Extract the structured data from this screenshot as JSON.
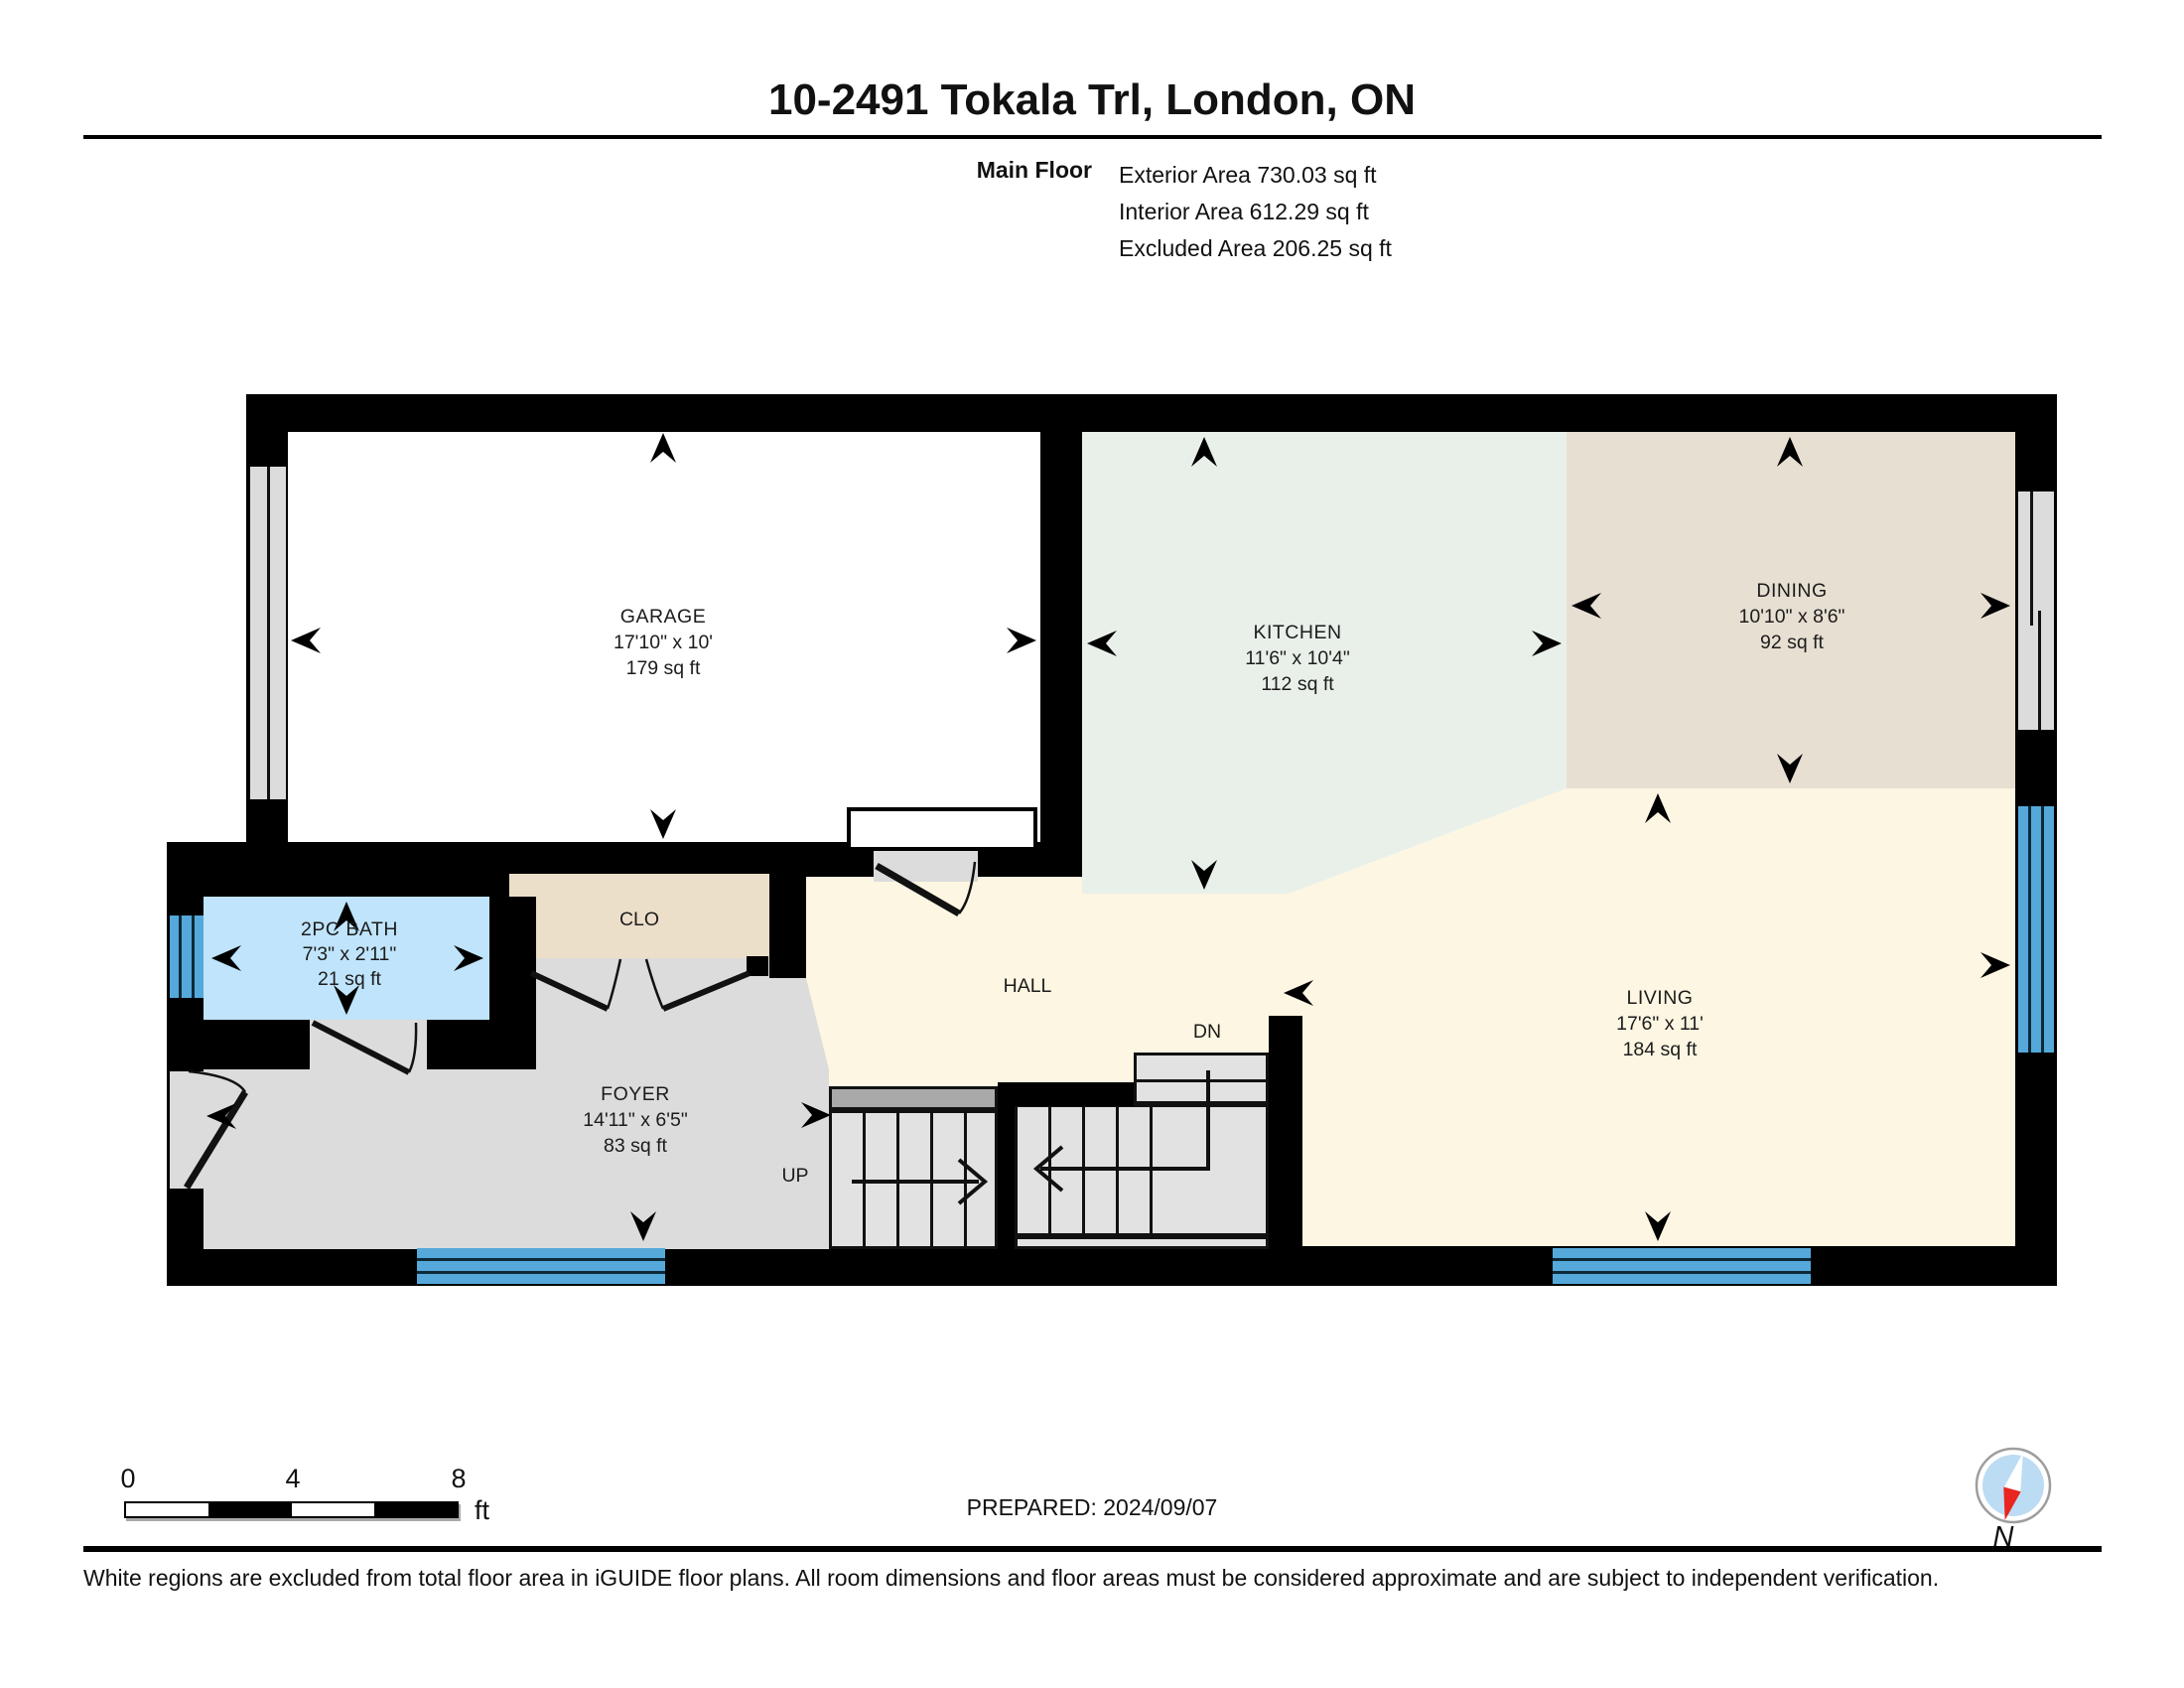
{
  "header": {
    "title": "10-2491 Tokala Trl, London, ON",
    "floor_label": "Main Floor",
    "area_lines": [
      "Exterior Area 730.03 sq ft",
      "Interior Area 612.29 sq ft",
      "Excluded Area 206.25 sq ft"
    ]
  },
  "rooms": {
    "garage": {
      "name": "GARAGE",
      "dims": "17'10\" x 10'",
      "area": "179 sq ft"
    },
    "kitchen": {
      "name": "KITCHEN",
      "dims": "11'6\" x 10'4\"",
      "area": "112 sq ft"
    },
    "dining": {
      "name": "DINING",
      "dims": "10'10\" x 8'6\"",
      "area": "92 sq ft"
    },
    "living": {
      "name": "LIVING",
      "dims": "17'6\" x 11'",
      "area": "184 sq ft"
    },
    "bath": {
      "name": "2PC BATH",
      "dims": "7'3\" x 2'11\"",
      "area": "21 sq ft"
    },
    "foyer": {
      "name": "FOYER",
      "dims": "14'11\" x 6'5\"",
      "area": "83 sq ft"
    },
    "hall": {
      "name": "HALL"
    },
    "closet": {
      "name": "CLO"
    },
    "stairs_up": {
      "name": "UP"
    },
    "stairs_down": {
      "name": "DN"
    }
  },
  "scale_bar": {
    "ticks": [
      "0",
      "4",
      "8"
    ],
    "unit": "ft"
  },
  "footer": {
    "prepared": "PREPARED: 2024/09/07",
    "disclaimer": "White regions are excluded from total floor area in iGUIDE floor plans. All room dimensions and floor areas must be considered approximate and are subject to independent verification.",
    "compass_label": "N"
  },
  "colors": {
    "wall": "#000000",
    "garage": "#ffffff",
    "kitchen": "#e8f0e9",
    "dining": "#e7dfd2",
    "living": "#fdf6e2",
    "foyer": "#dcdcdc",
    "bath": "#bfe4fb",
    "closet": "#ecdfc9",
    "window": "#55a9da",
    "stair": "#e2e2e2",
    "stair_landing": "#a9a9a9",
    "compass_fill": "#bcdcf4"
  }
}
